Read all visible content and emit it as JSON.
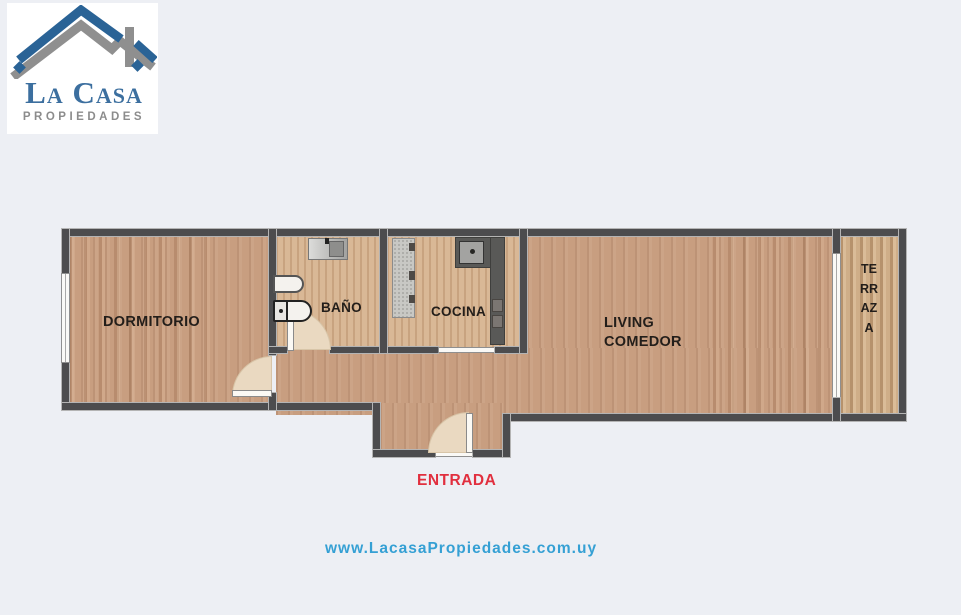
{
  "logo": {
    "brand": "La Casa",
    "tagline": "PROPIEDADES",
    "roof_blue": "#2a6396",
    "roof_gray": "#8f8f8f",
    "brand_blue": "#3c6f9f",
    "brand_gray": "#8c8c8c"
  },
  "plan": {
    "rooms": {
      "dormitorio": {
        "label": "DORMITORIO"
      },
      "bano": {
        "label": "BAÑO"
      },
      "cocina": {
        "label": "COCINA"
      },
      "living": {
        "label_line1": "LIVING",
        "label_line2": "COMEDOR"
      },
      "terraza": {
        "label": "TERRAZA"
      }
    },
    "entrance": {
      "label": "ENTRADA",
      "color": "#e12f3e"
    }
  },
  "footer": {
    "website": "www.LacasaPropiedades.com.uy",
    "color": "#35a0d4"
  },
  "colors": {
    "background": "#edeff4",
    "wall": "#4c4c4e",
    "floor_main": "#c89e80",
    "floor_light": "#d9b896"
  }
}
